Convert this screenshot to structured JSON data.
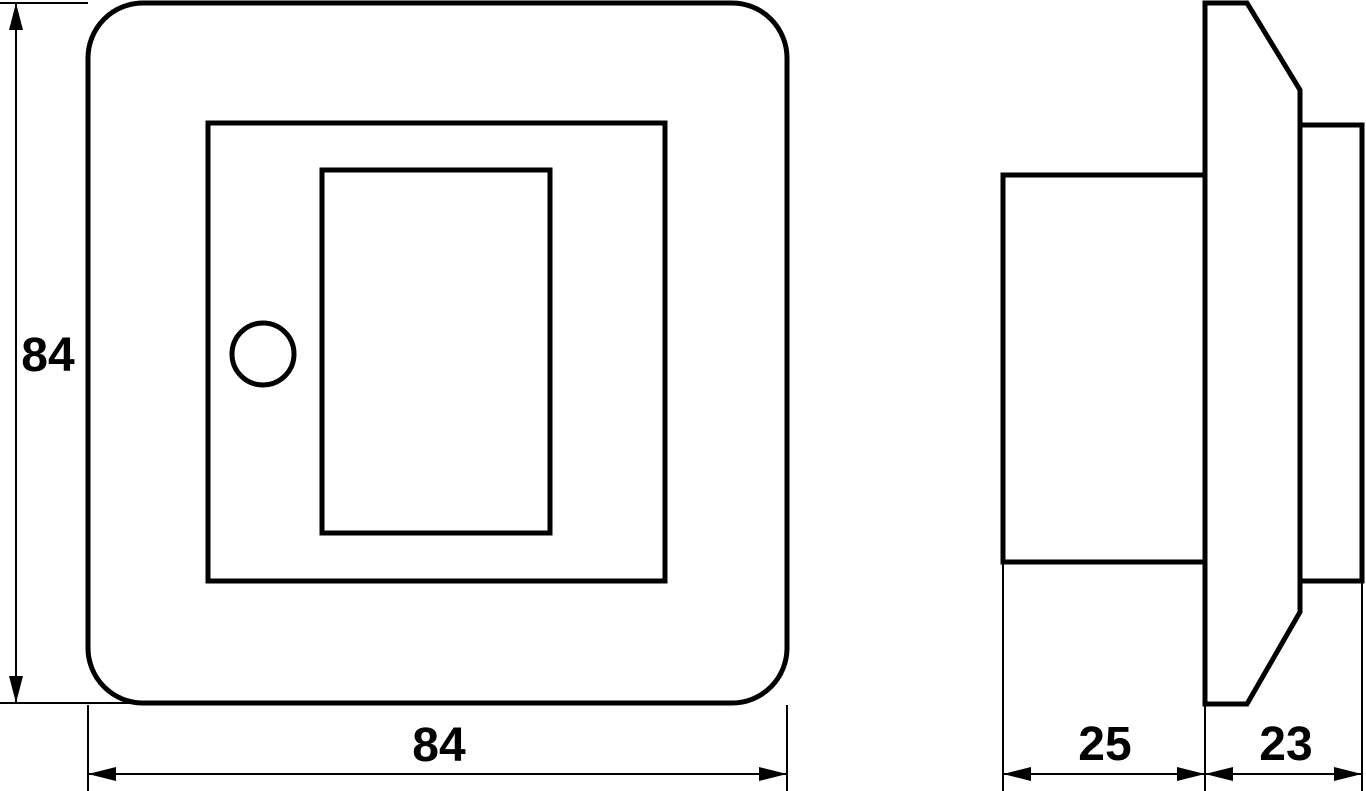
{
  "colors": {
    "line": "#000000",
    "background": "#ffffff"
  },
  "dimensions": {
    "front_height": {
      "value": "84"
    },
    "front_width": {
      "value": "84"
    },
    "side_rear_depth": {
      "value": "25"
    },
    "side_front_depth": {
      "value": "23"
    }
  }
}
